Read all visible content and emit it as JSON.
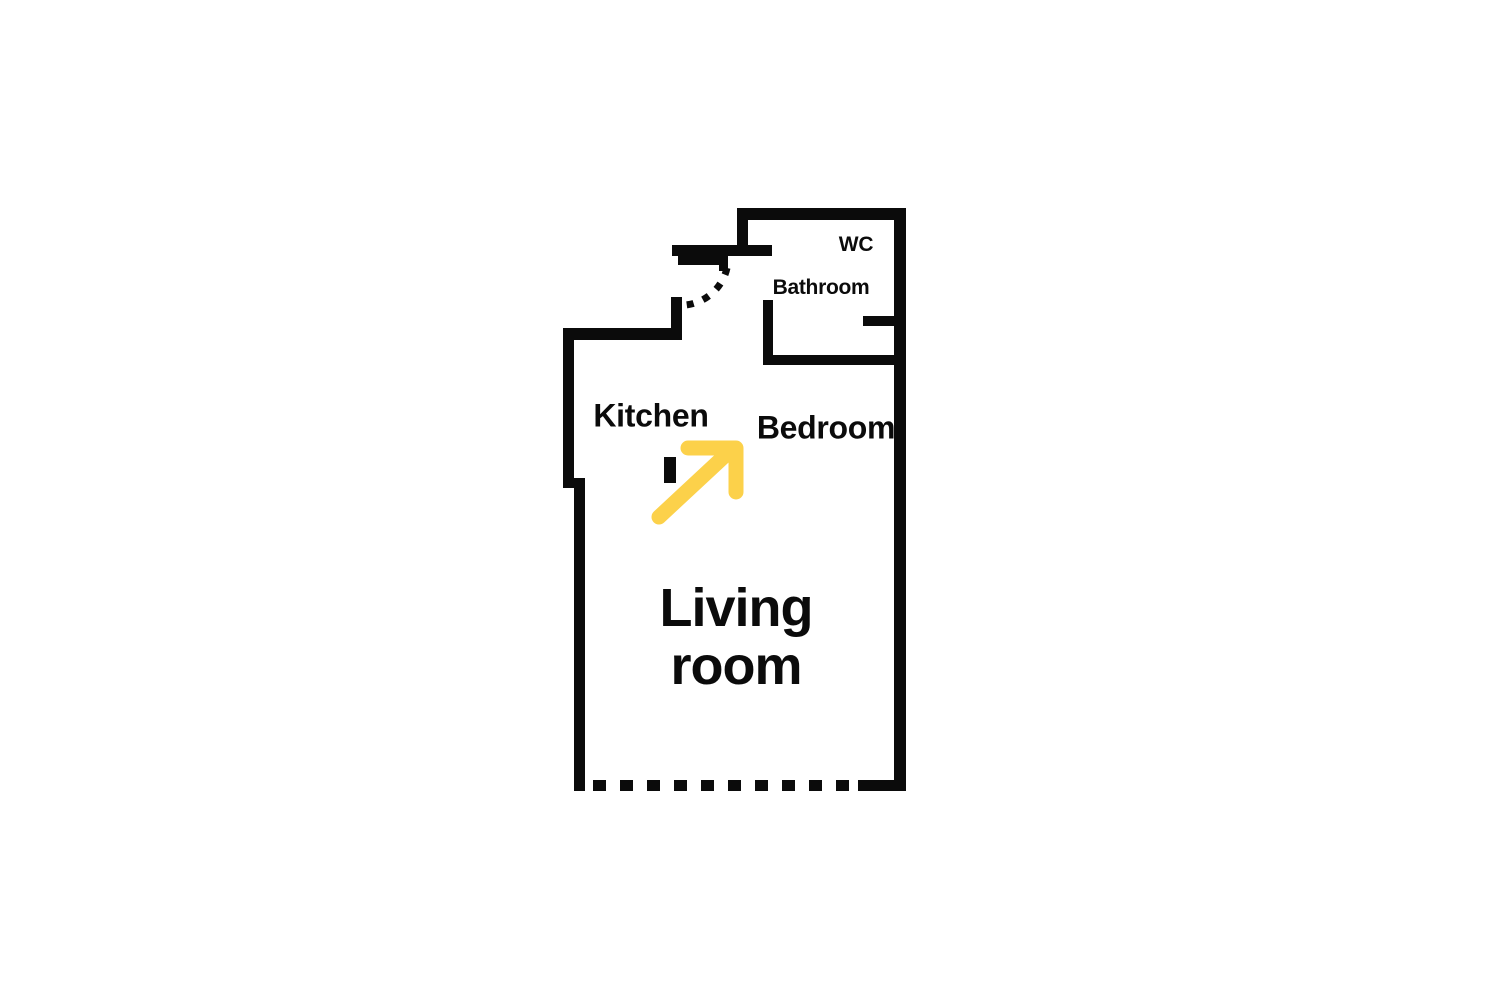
{
  "floor_plan": {
    "colors": {
      "wall": "#0b0b0b",
      "arrow": "#FCD14A",
      "background": "#ffffff"
    },
    "rooms": {
      "wc": {
        "label": "WC"
      },
      "bathroom": {
        "label": "Bathroom"
      },
      "kitchen": {
        "label": "Kitchen"
      },
      "bedroom": {
        "label": "Bedroom"
      },
      "living_room": {
        "label_line1": "Living",
        "label_line2": "room"
      }
    },
    "icons": {
      "direction_arrow": "up-right-arrow"
    }
  }
}
